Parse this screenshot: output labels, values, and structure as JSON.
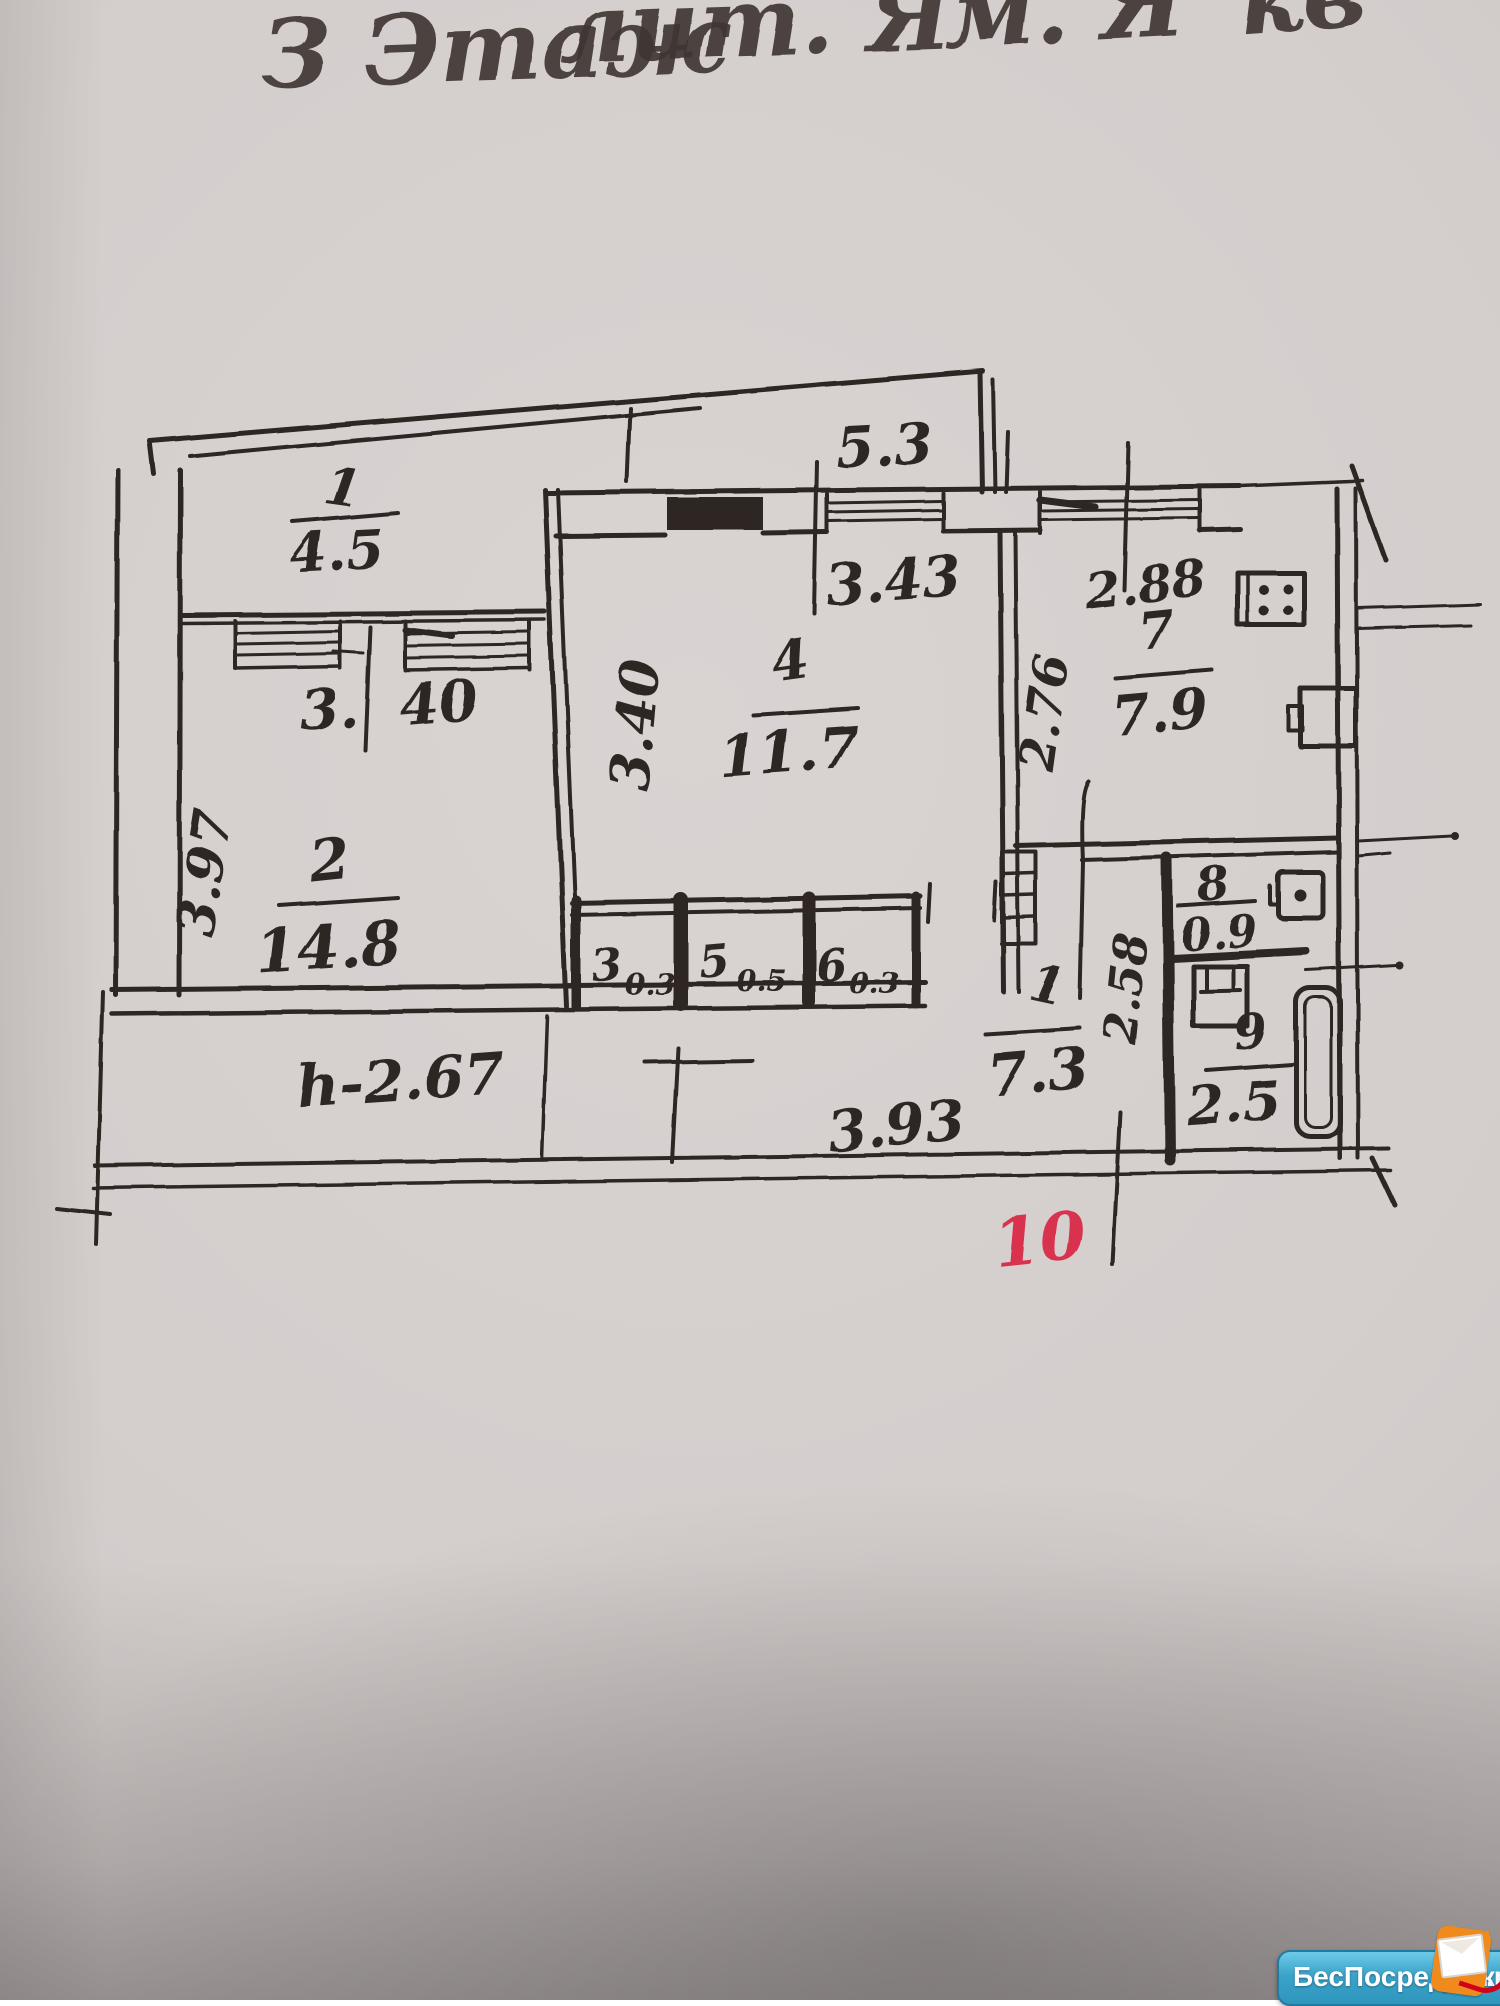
{
  "header": {
    "fragment1": "З Этаж",
    "fragment2": "лит. Я",
    "fragment3": "м. Я",
    "fragment4": "кв"
  },
  "plan": {
    "type": "hand-drawn apartment floor plan",
    "rooms": {
      "balcony": {
        "number": "1",
        "area": "4.5"
      },
      "living": {
        "number": "2",
        "area": "14.8"
      },
      "closet_a": {
        "number": "3",
        "area": "0.3"
      },
      "bedroom": {
        "number": "4",
        "area": "11.7"
      },
      "closet_b": {
        "number": "5",
        "area": "0.5"
      },
      "closet_c": {
        "number": "6",
        "area": "0.3"
      },
      "kitchen": {
        "number": "7",
        "area": "7.9"
      },
      "wc": {
        "number": "8",
        "area": "0.9"
      },
      "bathroom": {
        "number": "9",
        "area": "2.5"
      },
      "hallway": {
        "number": "1",
        "area": "7.3"
      }
    },
    "dimensions": {
      "balcony_top": "5.3",
      "bedroom_window": "3.43",
      "kitchen_window": "2.88",
      "kitchen_depth": "2.76",
      "bedroom_depth": "3.40",
      "living_window_a": "3.",
      "living_window_b": "40",
      "living_depth": "3.97",
      "bath_column_depth": "2.58",
      "hallway_bottom": "3.93"
    },
    "ceiling_height": "h-2.67",
    "red_mark": "10",
    "ink_color": "#2e2623",
    "red_color": "#d83350"
  },
  "watermark": {
    "brand": "БесПосредника",
    "suffix": ".ru",
    "pill_color": "#2f96bd",
    "mascot_color": "#f08a1d"
  }
}
